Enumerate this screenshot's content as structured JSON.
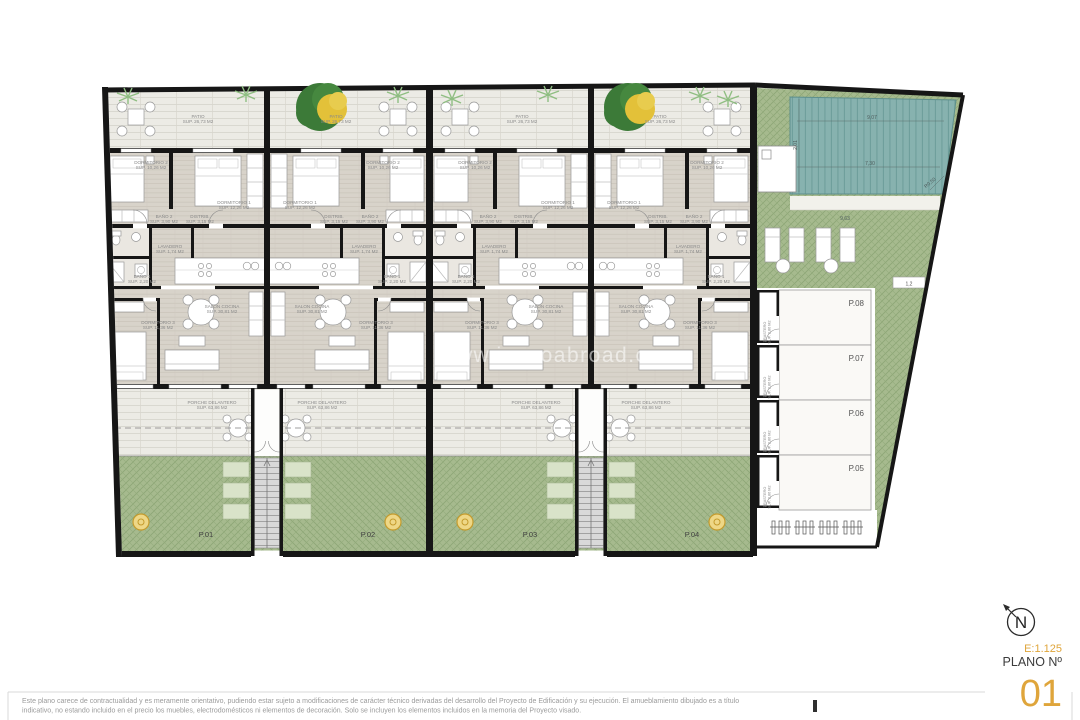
{
  "page": {
    "watermark": "www.immoabroad.com",
    "disclaimer_line1": "Este plano carece de contractualidad y es meramente orientativo, pudiendo estar sujeto a modificaciones de carácter técnico derivadas del desarrollo del Proyecto de Edificación y su ejecución. El amueblamiento dibujado es a título",
    "disclaimer_line2": "indicativo, no estando incluido en el precio los muebles, electrodomésticos ni elementos de decoración. Solo se incluyen los elementos incluidos en la memoria del Proyecto visado."
  },
  "title_block": {
    "scale": "E:1.125",
    "plan_label": "PLANO Nº",
    "plan_number": "01",
    "north": "N"
  },
  "rooms": {
    "patio": {
      "name": "PATIO",
      "sup": "SUP. 26,73 M2"
    },
    "dorm1": {
      "name": "DORMITORIO 1",
      "sup": "SUP. 12,26 M2"
    },
    "dorm2": {
      "name": "DORMITORIO 2",
      "sup": "SUP. 10,26 M2"
    },
    "dorm3": {
      "name": "DORMITORIO 3",
      "sup": "SUP. 11,36 M2"
    },
    "bath1": {
      "name": "BAÑO 1",
      "sup": "SUP. 2,20 M2"
    },
    "bath2": {
      "name": "BAÑO 2",
      "sup": "SUP. 3,90 M2"
    },
    "distrib": {
      "name": "DISTRIB.",
      "sup": "SUP. 3,15 M2"
    },
    "lavadero": {
      "name": "LAVADERO",
      "sup": "SUP. 1,74 M2"
    },
    "salon": {
      "name": "SALON COCINA",
      "sup": "SUP. 30,81 M2"
    },
    "porche": {
      "name": "PORCHE DELANTERO",
      "sup": "SUP. 63,86 M2"
    },
    "trastero": {
      "name": "TRASTERO",
      "sup": "SUP. 2,86 M2"
    }
  },
  "plots": [
    "P.01",
    "P.02",
    "P.03",
    "P.04"
  ],
  "parking": [
    "P.08",
    "P.07",
    "P.06",
    "P.05"
  ],
  "pool_dims": {
    "width_top": "9,07",
    "width_mid": "7,30",
    "depth_left": "2,01",
    "radius": "R0,50",
    "lawn_width": "9,63",
    "edge": "1,2"
  },
  "colors": {
    "accent_gold": "#DFA53B",
    "wall_black": "#161616",
    "pool_teal": "#87B2AF",
    "grass_green": "#A6BA8E",
    "planter_green": "#D9E3C9",
    "tree_green": "#3C7A38",
    "tree_bloom": "#E3C139",
    "label_gray": "#8A8A8A"
  }
}
